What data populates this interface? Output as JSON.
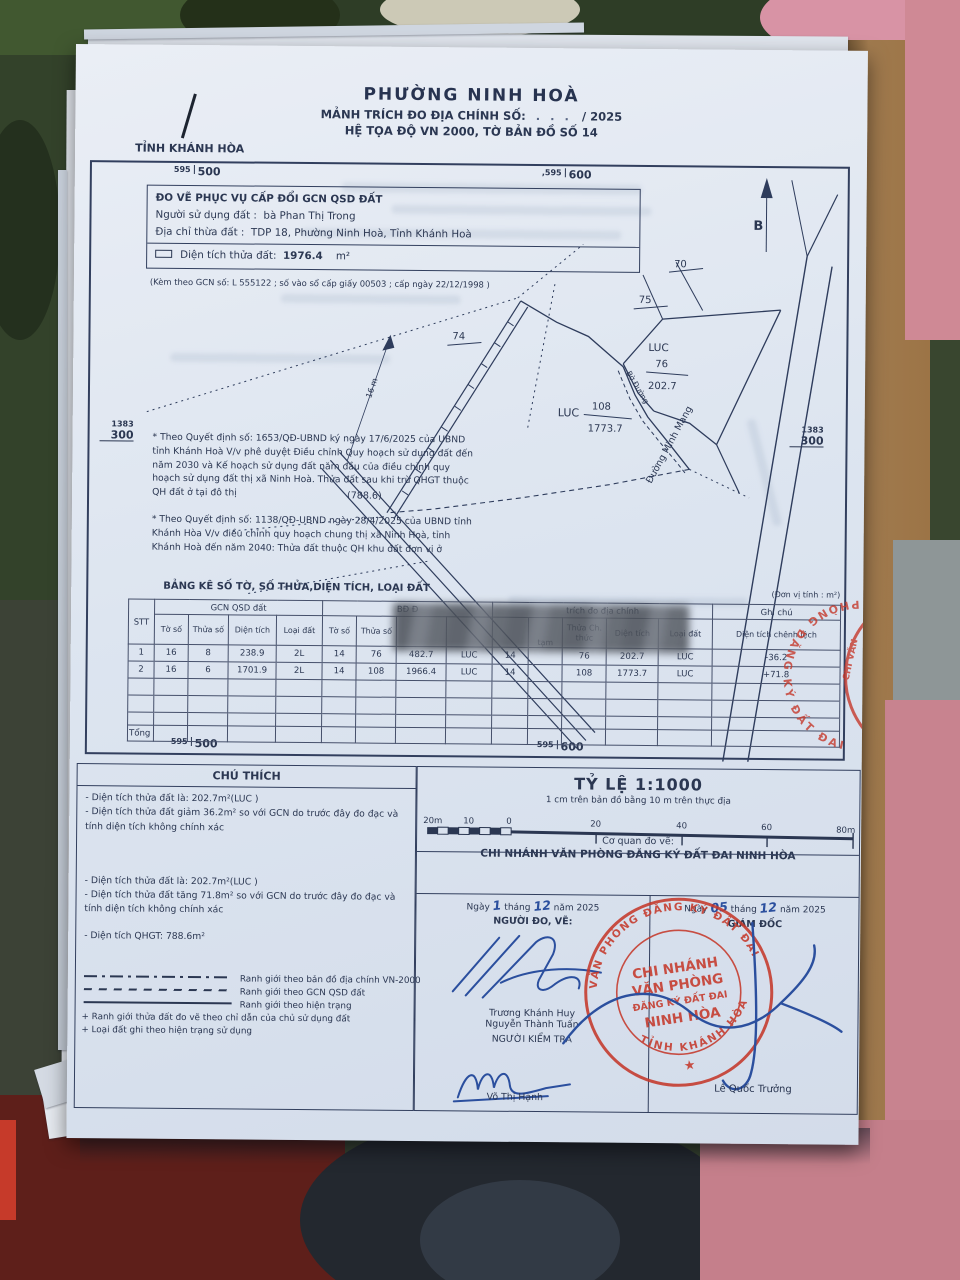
{
  "header": {
    "title": "PHƯỜNG NINH HOÀ",
    "subtitle_label": "MẢNH TRÍCH ĐO ĐỊA CHÍNH SỐ:",
    "subtitle_dots": ". . .",
    "subtitle_year": "/ 2025",
    "coord_line": "HỆ TỌA ĐỘ VN 2000, TỜ BẢN ĐỒ SỐ 14",
    "province": "TỈNH KHÁNH HÒA"
  },
  "map": {
    "north": "B",
    "grid": {
      "tl_small": "595",
      "tl_big": "500",
      "tr_small": ",595",
      "tr_big": "600",
      "l_top": "1383",
      "l_bot": "300",
      "r_top": "1383",
      "r_bot": "300",
      "bl_small": "595",
      "bl_big": "500",
      "br_small": "595",
      "br_big": "600"
    },
    "labels": {
      "p70": "70",
      "p75": "75",
      "p74": "74",
      "p76_code": "LUC",
      "p76_num": "76",
      "p76_area": "202.7",
      "p108_code": "LUC",
      "p108_num": "108",
      "p108_area": "1773.7",
      "area_note": "(788.6)",
      "width": "16 m",
      "road": "Đường Minh Mạng",
      "edge": "Bờ Đường"
    }
  },
  "info": {
    "line1": "ĐO VẼ PHỤC VỤ CẤP ĐỔI GCN QSD ĐẤT",
    "line2_label": "Người sử dụng đất :",
    "line2_value": "bà Phan Thị Trong",
    "line3_label": "Địa chỉ thừa đất :",
    "line3_value": "TDP 18, Phường Ninh Hoà, Tỉnh Khánh Hoà",
    "area_label": "Diện tích thửa đất:",
    "area_value": "1976.4",
    "area_unit": "m²",
    "gcn_note": "(Kèm theo GCN số: L 555122 ; số vào sổ cấp giấy 00503 ; cấp ngày 22/12/1998 )"
  },
  "notes": {
    "n1": "* Theo Quyết định số: 1653/QĐ-UBND ký ngày 17/6/2025 của UBND tỉnh Khánh Hoà V/v phê duyệt Điều chỉnh Quy hoạch sử dụng đất đến năm 2030 và Kế hoạch sử dụng đất năm đầu của điều chỉnh quy hoạch sử dụng đất thị xã Ninh Hoà. Thửa đất sau khi trừ QHGT thuộc QH đất ở tại đô thị",
    "n2": "* Theo Quyết định số: 1138/QĐ-UBND ngày 28/4/2025 của UBND tỉnh Khánh Hòa V/v điều chỉnh quy hoạch chung thị xã Ninh Hoà, tỉnh Khánh Hoà đến năm 2040: Thửa đất thuộc QH khu đất đơn vị ở"
  },
  "table": {
    "title": "BẢNG KÊ SỐ TỜ, SỐ THỬA,DIỆN TÍCH, LOẠI ĐẤT",
    "unit_note": "(Đơn vị tính : m²)",
    "stt_header": "STT",
    "groups": [
      {
        "label": "GCN QSD đất"
      },
      {
        "label": "BĐ Đ"
      },
      {
        "label": "trích đo địa chính"
      },
      {
        "label": "Ghi chú"
      }
    ],
    "sub_headers": [
      "Tờ số",
      "Thửa số",
      "Diện tích",
      "Loại đất",
      "Tờ số",
      "Thửa số",
      "",
      "",
      "",
      "tạm",
      "Thửa Ch. thức",
      "Diện tích",
      "Loại đất",
      "Diện tích chênh lệch"
    ],
    "rows": [
      [
        "1",
        "16",
        "8",
        "238.9",
        "2L",
        "14",
        "76",
        "482.7",
        "LUC",
        "14",
        "",
        "76",
        "202.7",
        "LUC",
        "-36.2"
      ],
      [
        "2",
        "16",
        "6",
        "1701.9",
        "2L",
        "14",
        "108",
        "1966.4",
        "LUC",
        "14",
        "",
        "108",
        "1773.7",
        "LUC",
        "+71.8"
      ]
    ],
    "total_label": "Tổng"
  },
  "chuthich": {
    "title": "CHÚ THÍCH",
    "group1": [
      "- Diện tích thửa đất  là: 202.7m²(LUC )",
      "- Diện tích thửa đất giảm 36.2m² so với GCN do trước đây đo đạc và tính diện tích không chính xác"
    ],
    "group2": [
      "- Diện tích thửa đất  là: 202.7m²(LUC )",
      "- Diện tích thửa đất tăng 71.8m² so với GCN do trước đây đo đạc và tính diện tích không chính xác",
      "- Diện tích QHGT: 788.6m²"
    ],
    "lines": [
      {
        "style": "dashdot",
        "label": "Ranh giới theo bản đồ địa chính VN-2000"
      },
      {
        "style": "dashed",
        "label": "Ranh giới theo GCN QSD đất"
      },
      {
        "style": "solid",
        "label": "Ranh giới theo hiện trạng"
      }
    ],
    "plus_notes": [
      "+ Ranh giới thửa đất đo vẽ theo chỉ dẫn của chủ sử dụng đất",
      "+ Loại đất ghi theo hiện trạng sử dụng"
    ]
  },
  "scale": {
    "title": "TỶ LỆ 1:1000",
    "subtitle": "1 cm trên bản đồ bằng 10 m trên thực địa",
    "left_labels": [
      "20m",
      "10",
      "0"
    ],
    "right_labels": [
      "20",
      "40",
      "60",
      "80m"
    ]
  },
  "agency": {
    "label": "Cơ quan đo vẽ:",
    "name": "CHI NHÁNH VĂN PHÒNG ĐĂNG KÝ ĐẤT ĐAI NINH HÒA"
  },
  "sign_left": {
    "ngay": "Ngày",
    "day": "1",
    "thang": "tháng",
    "month": "12",
    "nam": "năm 2025",
    "role": "NGƯỜI ĐO, VẼ:",
    "name1": "Trương Khánh Huy",
    "name2": "Nguyễn Thành Tuấn",
    "checker_role": "NGƯỜI KIỂM TRA",
    "checker_name": "Võ Thị Hạnh"
  },
  "sign_right": {
    "ngay": "Ngày",
    "day": "05",
    "thang": "tháng",
    "month": "12",
    "nam": "năm 2025",
    "role": "GIÁM ĐỐC",
    "name": "Lê Quốc Trưởng"
  },
  "stamp": {
    "line1": "CHI NHÁNH",
    "line2": "VĂN PHÒNG",
    "line3": "ĐĂNG KÝ ĐẤT ĐAI",
    "line4": "NINH HÒA",
    "ring_top": "VĂN PHÒNG ĐĂNG KÝ ĐẤT ĐAI",
    "ring_bottom": "TỈNH KHÁNH HÒA",
    "star": "★"
  },
  "side_stamp": {
    "ring_text": "PHÒNG ĐĂNG KÝ ĐẤT ĐAI",
    "inner_text": "CHI VĂN"
  }
}
